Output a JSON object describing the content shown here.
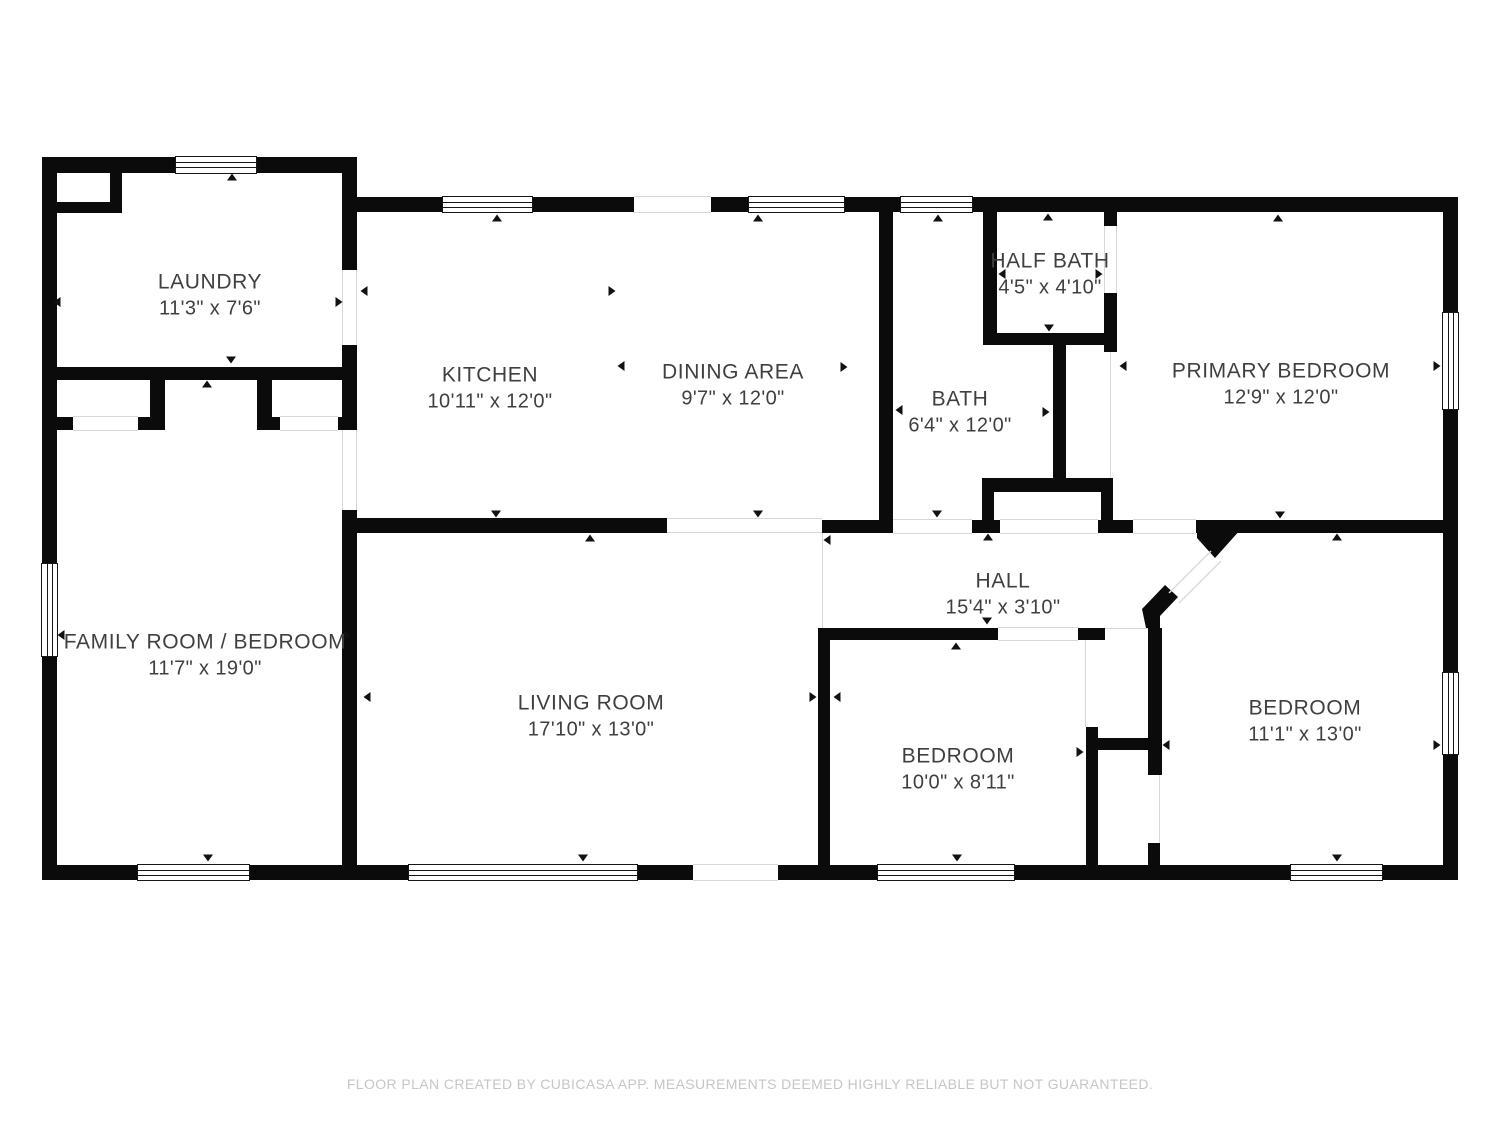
{
  "footer": "FLOOR PLAN CREATED BY CUBICASA APP. MEASUREMENTS DEEMED HIGHLY RELIABLE BUT NOT GUARANTEED.",
  "colors": {
    "wall": "#0b0b0b",
    "label_text": "#3f3f3f",
    "footer_text": "#c6c6c6",
    "opening_line": "#d8d8d8"
  },
  "rooms": [
    {
      "id": "laundry",
      "name": "LAUNDRY",
      "dims": "11'3\" x 7'6\""
    },
    {
      "id": "kitchen",
      "name": "KITCHEN",
      "dims": "10'11\" x 12'0\""
    },
    {
      "id": "dining-area",
      "name": "DINING AREA",
      "dims": "9'7\" x 12'0\""
    },
    {
      "id": "half-bath",
      "name": "HALF BATH",
      "dims": "4'5\" x 4'10\""
    },
    {
      "id": "bath",
      "name": "BATH",
      "dims": "6'4\" x 12'0\""
    },
    {
      "id": "primary-bedroom",
      "name": "PRIMARY BEDROOM",
      "dims": "12'9\" x 12'0\""
    },
    {
      "id": "family-room-bedroom",
      "name": "FAMILY ROOM / BEDROOM",
      "dims": "11'7\" x 19'0\""
    },
    {
      "id": "living-room",
      "name": "LIVING ROOM",
      "dims": "17'10\" x 13'0\""
    },
    {
      "id": "hall",
      "name": "HALL",
      "dims": "15'4\" x 3'10\""
    },
    {
      "id": "bedroom-middle",
      "name": "BEDROOM",
      "dims": "10'0\" x 8'11\""
    },
    {
      "id": "bedroom-right",
      "name": "BEDROOM",
      "dims": "11'1\" x 13'0\""
    }
  ]
}
